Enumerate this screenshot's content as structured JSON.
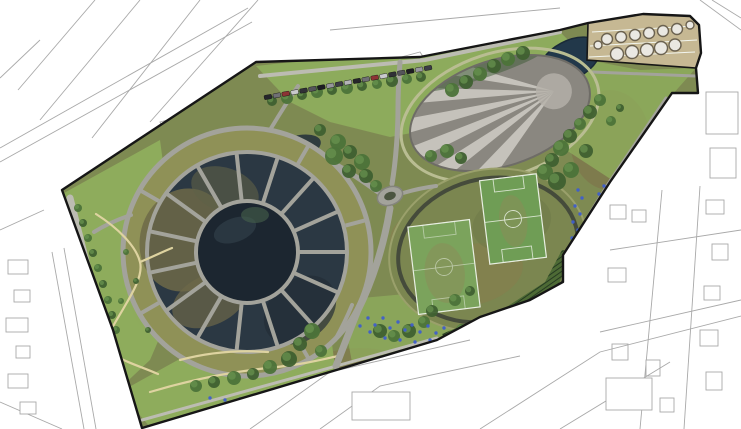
{
  "scene": {
    "type": "aerial-masterplan",
    "description": "Aerial masterplan rendering of a large park set within white line-drawn city blocks"
  },
  "palette": {
    "bg": "#ffffff",
    "cityline": "#a9a9a9",
    "boundary": "#161616",
    "meadow": "#7e8a52",
    "meadow_ring": "#8f9157",
    "lawn": "#8fae5d",
    "path": "#a3a39b",
    "pathlight": "#bcbcb2",
    "yellowpath": "#ded3a0",
    "water": "#1c2630",
    "wetland": "#2b3843",
    "marsh": "#6d6848",
    "mound_base": "#8a8780",
    "mound_ray": "#c9c6be",
    "mound_edge": "#6e6c66",
    "pond_ne": "#22384a",
    "pitch_green": "#6f9d55",
    "pitch_green2": "#7ba35c",
    "pitch_line": "#e8efe2",
    "sports_ring": "#454b3b",
    "tan": "#c6b893",
    "tank_fill": "#eae8e2",
    "tank_stroke": "#6b6250",
    "tree_dark": "#3f6030",
    "tree_mid": "#4c7339",
    "tree_light": "#6a9450",
    "people_blue": "#3f5ecc",
    "hatch_base": "#4d6a35",
    "hatch_line": "#22351f"
  },
  "features": {
    "radial_wetland_garden": {
      "label": "Radial wetland garden with concentric ring paths and central pond",
      "cx": 247,
      "cy": 252,
      "outer_ring_r": 124,
      "mid_ring_r": 100,
      "pond_r": 50
    },
    "striped_mound": {
      "label": "Elliptical gravel mound with radiating light stripes",
      "cx": 500,
      "cy": 113,
      "rx": 93,
      "ry": 53,
      "rotation_deg": -18,
      "ray_count": 6
    },
    "mound_pond": {
      "label": "Dark pond at north-east tip of mound",
      "cx": 570,
      "cy": 60
    },
    "sports_oval": {
      "label": "Oval sports meadow with two football pitches and dark running loop",
      "cx": 488,
      "cy": 250,
      "rx": 100,
      "ry": 80,
      "rotation_deg": -15,
      "pitch_count": 2
    },
    "tank_farm": {
      "label": "Tan works yard with two rows of circular tanks",
      "tank_count": 13
    },
    "parking_row": {
      "label": "Row of parked cars along the north boundary road",
      "car_count": 19
    },
    "roundabout": {
      "label": "Small oval path junction",
      "cx": 390,
      "cy": 196
    },
    "terraced_bank": {
      "label": "Hatched terraced bank at the south-east corner"
    }
  },
  "decorations": {
    "spokes": {
      "cx": 247,
      "cy": 252,
      "inner": 52,
      "outer": 100,
      "width": 4,
      "angles": [
        0,
        24,
        48,
        72,
        96,
        120,
        144,
        168,
        192,
        216,
        240,
        264,
        288,
        312,
        336
      ]
    },
    "outer_spokes": {
      "cx": 247,
      "cy": 252,
      "inner": 102,
      "outer": 123,
      "width": 4,
      "angles": [
        60,
        150,
        210,
        300,
        345
      ]
    },
    "tanks": [
      [
        607,
        39,
        5.5
      ],
      [
        621,
        37,
        5.5
      ],
      [
        635,
        35,
        5.5
      ],
      [
        649,
        33,
        5.5
      ],
      [
        663,
        31,
        5.5
      ],
      [
        677,
        29,
        5.5
      ],
      [
        617,
        54,
        6.5
      ],
      [
        632,
        52,
        6.5
      ],
      [
        647,
        50,
        6.5
      ],
      [
        661,
        48,
        6.5
      ],
      [
        675,
        45,
        6
      ],
      [
        598,
        45,
        4
      ],
      [
        690,
        25,
        4
      ]
    ],
    "cars": {
      "from": [
        268,
        97
      ],
      "to": [
        428,
        68
      ],
      "count": 19,
      "colors": [
        "#26262b",
        "#6f6f74",
        "#8c3434",
        "#c9c9cc",
        "#303036",
        "#54545a",
        "#1d1d22",
        "#96969c",
        "#3c3c46",
        "#b3b3b8"
      ]
    },
    "trees": [
      [
        78,
        208,
        4
      ],
      [
        83,
        223,
        4
      ],
      [
        88,
        238,
        4
      ],
      [
        93,
        253,
        4
      ],
      [
        98,
        268,
        4
      ],
      [
        103,
        284,
        4
      ],
      [
        108,
        300,
        4
      ],
      [
        112,
        315,
        4
      ],
      [
        116,
        330,
        4
      ],
      [
        272,
        101,
        5
      ],
      [
        287,
        98,
        6
      ],
      [
        302,
        95,
        5
      ],
      [
        317,
        92,
        6
      ],
      [
        332,
        90,
        5
      ],
      [
        347,
        88,
        6
      ],
      [
        362,
        86,
        5
      ],
      [
        377,
        84,
        5
      ],
      [
        392,
        81,
        6
      ],
      [
        407,
        79,
        5
      ],
      [
        421,
        77,
        5
      ],
      [
        338,
        142,
        8
      ],
      [
        350,
        152,
        7
      ],
      [
        362,
        162,
        8
      ],
      [
        349,
        171,
        7
      ],
      [
        334,
        156,
        9
      ],
      [
        366,
        176,
        7
      ],
      [
        376,
        186,
        6
      ],
      [
        320,
        130,
        6
      ],
      [
        452,
        90,
        7
      ],
      [
        466,
        82,
        7
      ],
      [
        480,
        74,
        7
      ],
      [
        494,
        66,
        7
      ],
      [
        508,
        59,
        7
      ],
      [
        523,
        53,
        7
      ],
      [
        600,
        100,
        6
      ],
      [
        590,
        112,
        7
      ],
      [
        580,
        124,
        6
      ],
      [
        570,
        136,
        7
      ],
      [
        561,
        148,
        8
      ],
      [
        552,
        160,
        7
      ],
      [
        545,
        172,
        8
      ],
      [
        557,
        181,
        9
      ],
      [
        571,
        170,
        8
      ],
      [
        586,
        151,
        7
      ],
      [
        611,
        121,
        5
      ],
      [
        620,
        108,
        4
      ],
      [
        312,
        331,
        8
      ],
      [
        300,
        344,
        7
      ],
      [
        321,
        351,
        6
      ],
      [
        289,
        359,
        8
      ],
      [
        270,
        367,
        7
      ],
      [
        253,
        374,
        6
      ],
      [
        234,
        378,
        7
      ],
      [
        214,
        382,
        6
      ],
      [
        196,
        386,
        6
      ],
      [
        380,
        331,
        7
      ],
      [
        394,
        336,
        6
      ],
      [
        409,
        331,
        7
      ],
      [
        424,
        322,
        6
      ],
      [
        432,
        311,
        6
      ],
      [
        455,
        300,
        6
      ],
      [
        470,
        291,
        5
      ],
      [
        462,
        330,
        6
      ],
      [
        476,
        327,
        5
      ],
      [
        126,
        252,
        3
      ],
      [
        136,
        281,
        3
      ],
      [
        121,
        301,
        3
      ],
      [
        148,
        330,
        3
      ],
      [
        447,
        151,
        7
      ],
      [
        461,
        158,
        6
      ],
      [
        431,
        156,
        6
      ]
    ],
    "people_dots": [
      [
        578,
        190
      ],
      [
        582,
        198
      ],
      [
        575,
        206
      ],
      [
        580,
        214
      ],
      [
        573,
        222
      ],
      [
        578,
        230
      ],
      [
        572,
        238
      ],
      [
        576,
        246
      ],
      [
        570,
        254
      ],
      [
        567,
        262
      ],
      [
        604,
        186
      ],
      [
        599,
        194
      ],
      [
        368,
        318
      ],
      [
        375,
        325
      ],
      [
        383,
        318
      ],
      [
        390,
        328
      ],
      [
        398,
        322
      ],
      [
        405,
        330
      ],
      [
        412,
        325
      ],
      [
        420,
        332
      ],
      [
        428,
        326
      ],
      [
        436,
        333
      ],
      [
        444,
        328
      ],
      [
        452,
        334
      ],
      [
        400,
        340
      ],
      [
        385,
        338
      ],
      [
        415,
        342
      ],
      [
        430,
        340
      ],
      [
        370,
        332
      ],
      [
        360,
        326
      ],
      [
        445,
        340
      ],
      [
        455,
        336
      ],
      [
        210,
        398
      ],
      [
        225,
        400
      ],
      [
        240,
        399
      ]
    ]
  }
}
